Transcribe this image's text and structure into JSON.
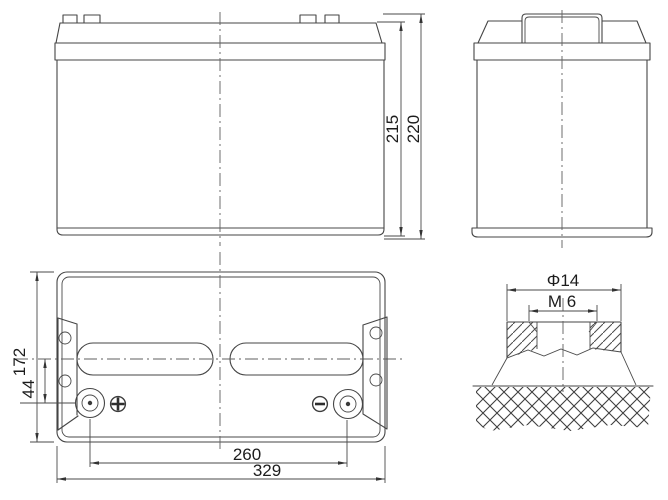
{
  "drawing": {
    "description": "battery outline dimension drawing",
    "background": "#ffffff",
    "line_color": "#454545",
    "centerline_color": "#5f5f5f",
    "text_color": "#1c1c1c",
    "front_view": {
      "height_case": "215",
      "height_total": "220"
    },
    "top_view": {
      "depth": "172",
      "terminal_offset": "44",
      "terminal_pitch": "260",
      "length": "329",
      "positive_symbol": "+",
      "negative_symbol": "−"
    },
    "terminal_detail": {
      "diameter": "Φ14",
      "thread": "M 6"
    }
  }
}
